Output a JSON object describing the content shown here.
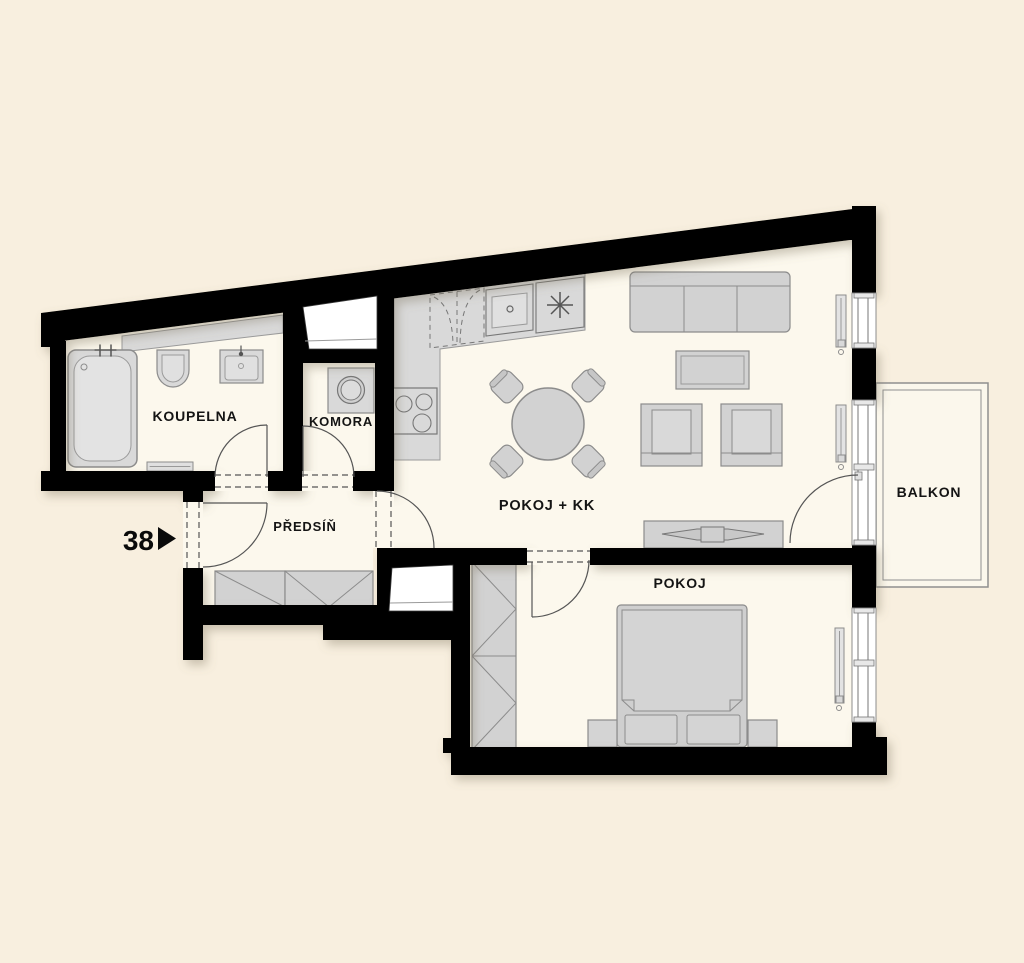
{
  "title": "Apartment floor plan",
  "unit_marker": {
    "number": "38"
  },
  "rooms": {
    "koupelna": {
      "label": "KOUPELNA"
    },
    "komora": {
      "label": "KOMORA"
    },
    "predsin": {
      "label": "PŘEDSÍŇ"
    },
    "pokoj_kk": {
      "label": "POKOJ + KK"
    },
    "pokoj": {
      "label": "POKOJ"
    },
    "balkon": {
      "label": "BALKON"
    }
  },
  "colors": {
    "background": "#f8efdf",
    "room_floor": "#fcf8ed",
    "wall": "#000000",
    "furniture_fill": "#d2d2d2",
    "furniture_stroke": "#8c8c8c",
    "window_fill": "#ffffff",
    "detail_line": "#555555",
    "label_text": "#141414"
  }
}
